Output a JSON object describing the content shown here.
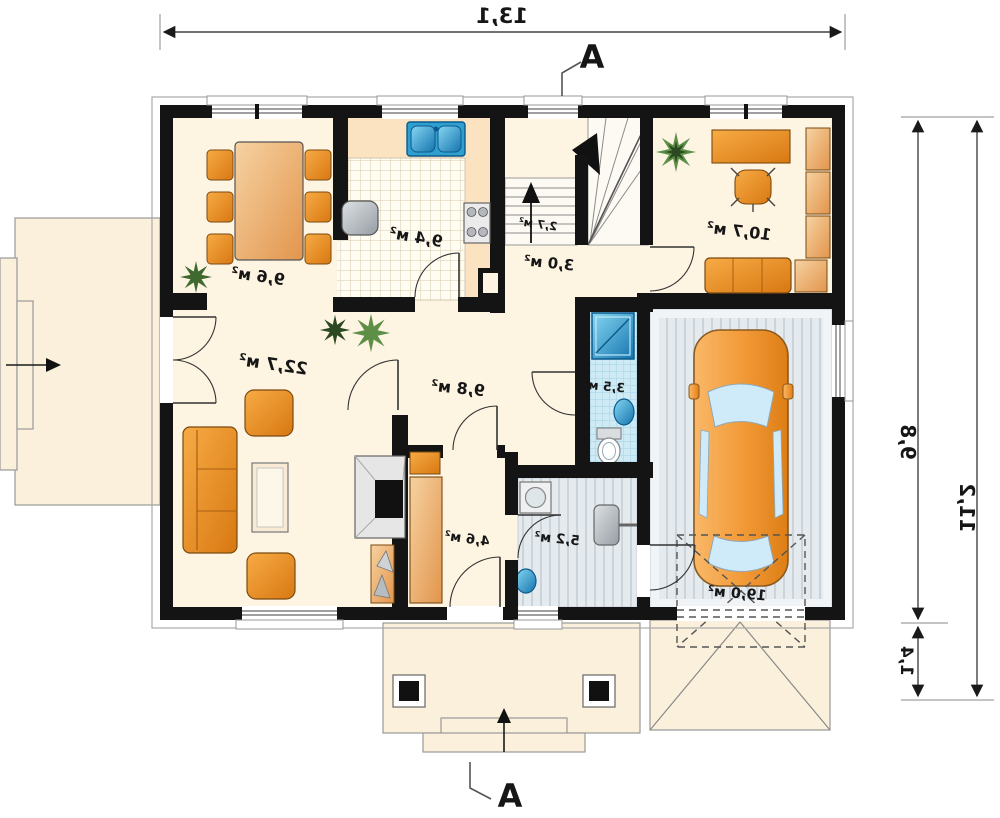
{
  "plan": {
    "section_label": "A",
    "dimensions": {
      "width": "13,1",
      "depth": "9,8",
      "garage_extension": "1,4",
      "total_depth": "11,2"
    },
    "rooms": {
      "dining": "9,6 м²",
      "kitchen": "9,4 м²",
      "stairs": "2,7 м²",
      "hall": "3,0 м²",
      "office": "10,7 м²",
      "living": "22,7 м²",
      "hallway": "9,8 м²",
      "bathroom": "3,5 м²",
      "corridor": "4,6 м²",
      "utility": "5,2 м²",
      "garage": "19,0 м²"
    },
    "colors": {
      "wall": "#141414",
      "floor": "#fdf4e2",
      "terrace": "#faf0dc",
      "furniture_orange": "#e8892f",
      "bath_tile": "#cdeaf5",
      "garage_floor": "#e4eaee",
      "fixture_blue": "#2f9fd0",
      "plant_green": "#55863f"
    }
  }
}
